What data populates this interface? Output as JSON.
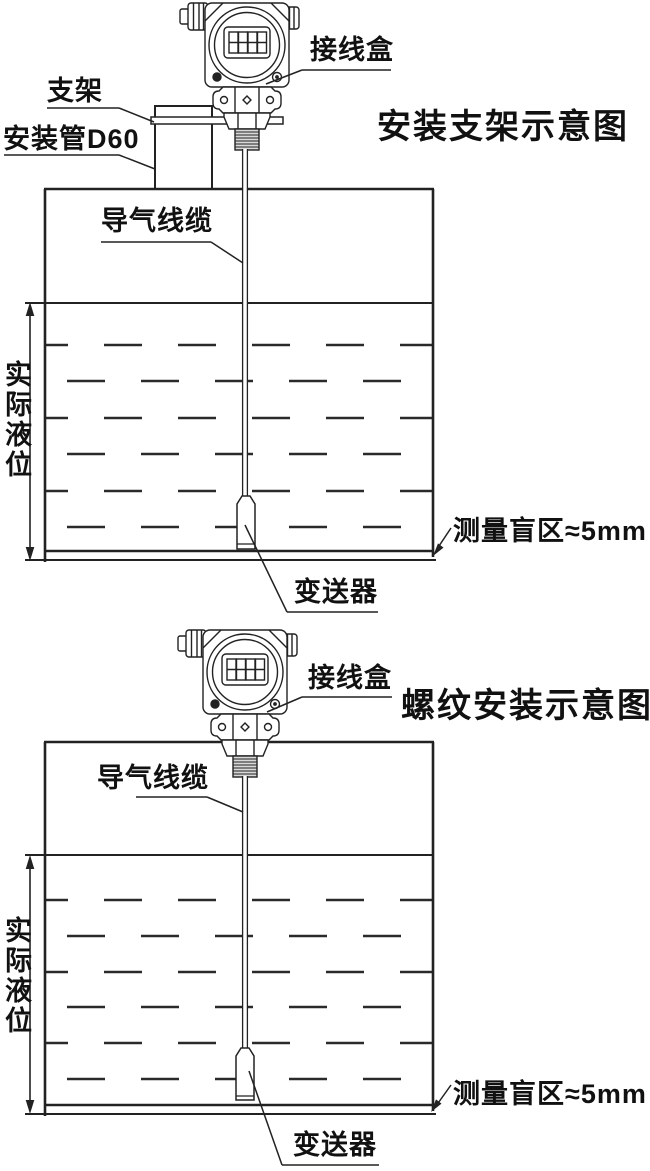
{
  "colors": {
    "line": "#222222",
    "text": "#111111",
    "background": "#ffffff"
  },
  "top_diagram": {
    "title": "安装支架示意图",
    "junction_box_label": "接线盒",
    "bracket_label": "支架",
    "mounting_pipe_label": "安装管D60",
    "air_cable_label": "导气线缆",
    "actual_level_label": "实际液位",
    "blind_zone_label": "测量盲区≈5mm",
    "transmitter_label": "变送器"
  },
  "bottom_diagram": {
    "title": "螺纹安装示意图",
    "junction_box_label": "接线盒",
    "air_cable_label": "导气线缆",
    "actual_level_label": "实际液位",
    "blind_zone_label": "测量盲区≈5mm",
    "transmitter_label": "变送器"
  }
}
